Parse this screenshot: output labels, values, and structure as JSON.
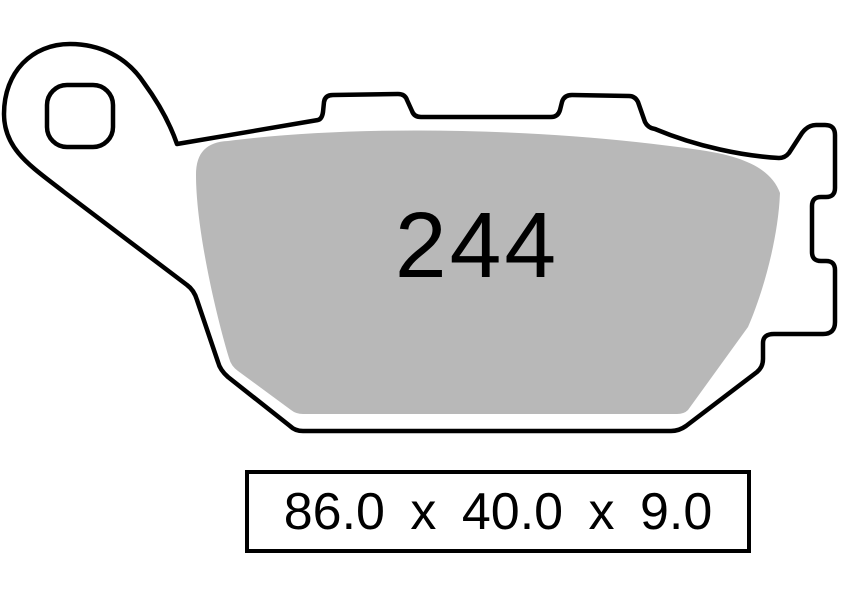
{
  "part": {
    "number": "244",
    "dimensions_label": "86.0 x 40.0 x 9.0"
  },
  "drawing": {
    "subject": "brake-pad-outline-top-view",
    "features": {
      "mounting_hole": "rounded-square-hole-left-ear",
      "top_tabs": 2,
      "right_tab_notch": 1
    }
  },
  "colors": {
    "background": "#ffffff",
    "outline": "#000000",
    "friction_material": "#b8b8b8",
    "text": "#000000"
  }
}
